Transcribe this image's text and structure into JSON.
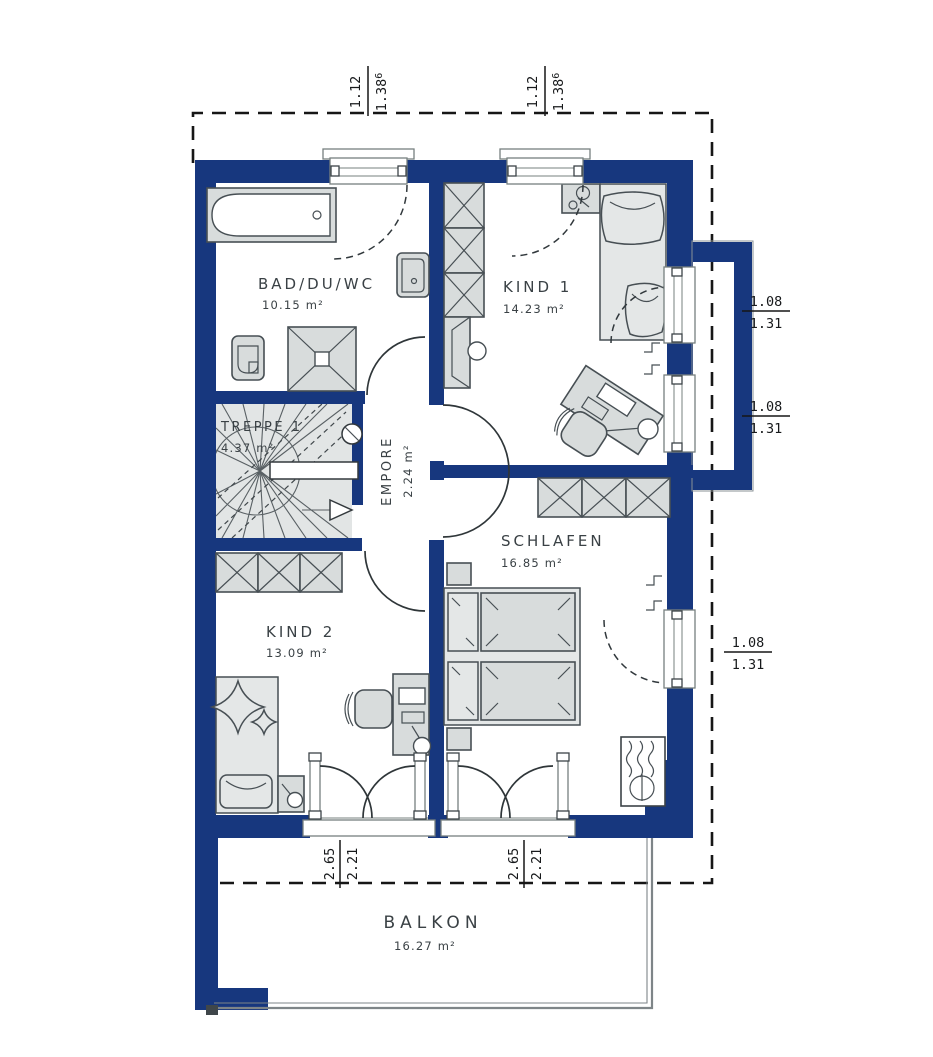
{
  "colors": {
    "wall": "#17377E",
    "furn_fill": "#D8DCDC",
    "furn_stroke": "#474F54",
    "stair_fill": "#E2E5E5",
    "text": "#3A4145",
    "railing": "#7E8588"
  },
  "rooms": [
    {
      "name": "BAD/DU/WC",
      "area": "10.15 m²"
    },
    {
      "name": "KIND 1",
      "area": "14.23 m²"
    },
    {
      "name": "TREPPE 1",
      "area": "4.37 m²"
    },
    {
      "name": "EMPORE",
      "area": "2.24 m²"
    },
    {
      "name": "SCHLAFEN",
      "area": "16.85 m²"
    },
    {
      "name": "KIND 2",
      "area": "13.09 m²"
    },
    {
      "name": "BALKON",
      "area": "16.27 m²"
    }
  ],
  "dimensions": {
    "top": [
      {
        "first": "1.12",
        "second": "1.38",
        "second_sup": "6"
      },
      {
        "first": "1.12",
        "second": "1.38",
        "second_sup": "6"
      }
    ],
    "right": [
      {
        "top": "1.08",
        "bottom": "1.31"
      },
      {
        "top": "1.08",
        "bottom": "1.31"
      },
      {
        "top": "1.08",
        "bottom": "1.31"
      }
    ],
    "bottom": [
      {
        "first": "2.65",
        "second": "2.21"
      },
      {
        "first": "2.65",
        "second": "2.21"
      }
    ]
  }
}
